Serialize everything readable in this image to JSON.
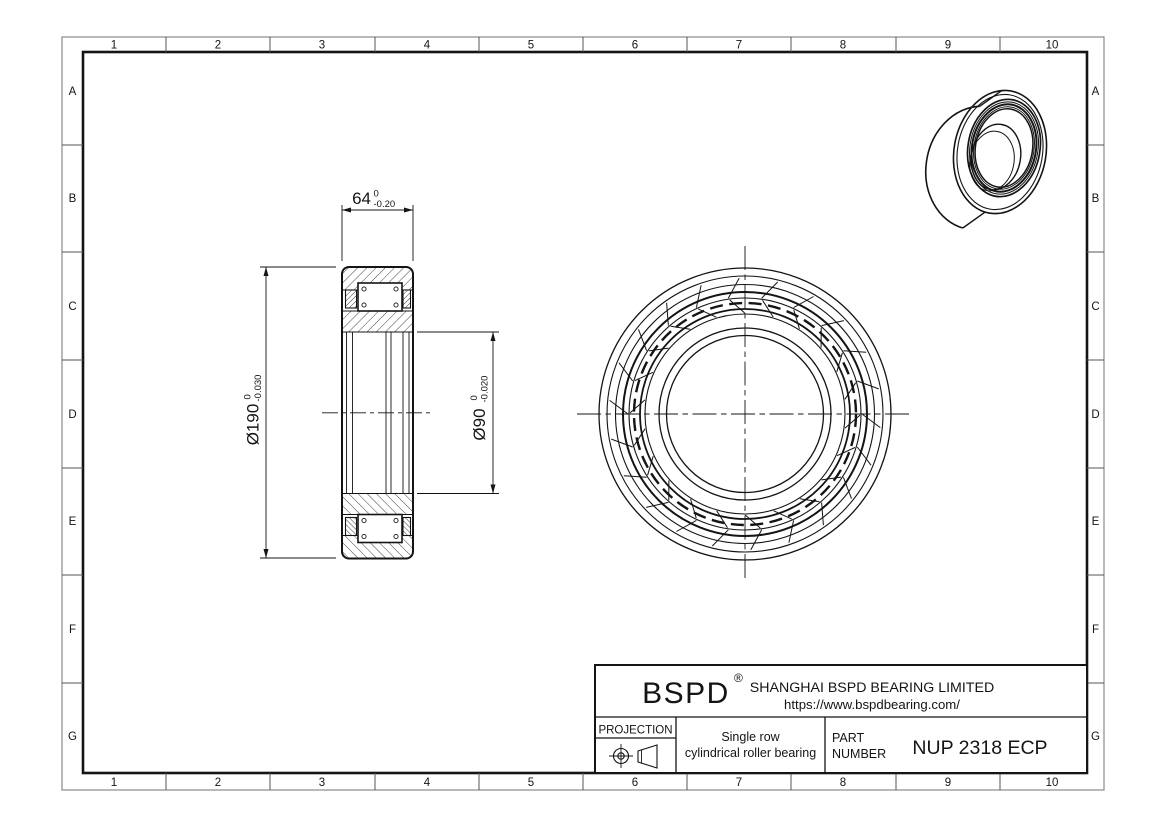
{
  "sheet": {
    "grid_columns": [
      "1",
      "2",
      "3",
      "4",
      "5",
      "6",
      "7",
      "8",
      "9",
      "10"
    ],
    "grid_rows": [
      "A",
      "B",
      "C",
      "D",
      "E",
      "F",
      "G"
    ]
  },
  "title_block": {
    "logo": "BSPD",
    "registered_mark": "®",
    "company": "SHANGHAI BSPD BEARING LIMITED",
    "website": "https://www.bspdbearing.com/",
    "projection_label": "PROJECTION",
    "description_line1": "Single row",
    "description_line2": "cylindrical roller bearing",
    "part_label_line1": "PART",
    "part_label_line2": "NUMBER",
    "part_number": "NUP 2318 ECP"
  },
  "dimensions": {
    "width_value": "64",
    "width_tol_upper": "0",
    "width_tol_lower": "-0.20",
    "outer_dia_value": "Ø190",
    "outer_dia_tol_upper": "0",
    "outer_dia_tol_lower": "-0.030",
    "bore_dia_value": "Ø90",
    "bore_dia_tol_upper": "0",
    "bore_dia_tol_lower": "-0.020"
  },
  "colors": {
    "line": "#141414",
    "outer_border": "#8a8a8a",
    "background": "#ffffff"
  }
}
